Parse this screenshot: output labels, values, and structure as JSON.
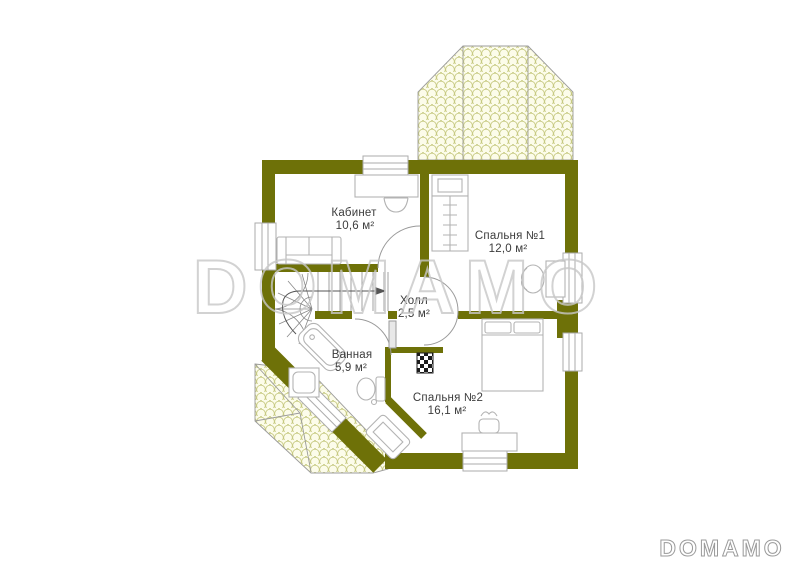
{
  "watermark": {
    "text": "DOMAMO"
  },
  "brand_logo": {
    "text": "DOMAMO"
  },
  "rooms": [
    {
      "name": "Кабинет",
      "area": "10,6 м²"
    },
    {
      "name": "Спальня №1",
      "area": "12,0 м²"
    },
    {
      "name": "Холл",
      "area": "2,5 м²"
    },
    {
      "name": "Ванная",
      "area": "5,9 м²"
    },
    {
      "name": "Спальня №2",
      "area": "16,1 м²"
    }
  ],
  "colors": {
    "wall": "#6e7108",
    "roof_fill": "#fcfcea",
    "roof_scale_stroke": "#c6c980",
    "roof_edge": "#9c9c9c",
    "furniture_line": "#b3b3b3",
    "stair_line": "#8a8a8a",
    "door_arc": "#9a9a9a",
    "label_text": "#3c3c3c",
    "watermark_outline": "#c8c8c8"
  }
}
